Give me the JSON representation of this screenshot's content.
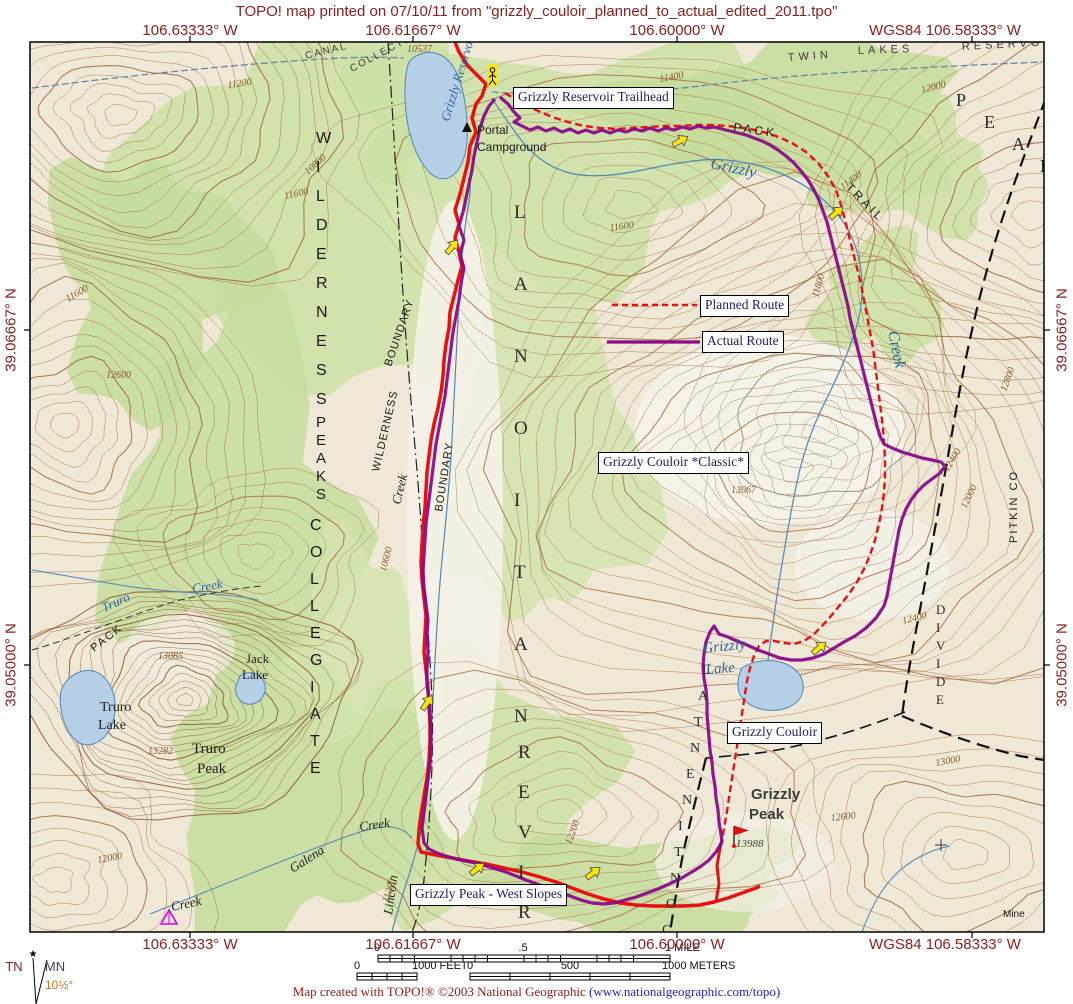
{
  "title": "TOPO! map printed on 07/10/11 from \"grizzly_couloir_planned_to_actual_edited_2011.tpo\"",
  "coords": {
    "top": [
      "106.63333° W",
      "106.61667° W",
      "106.60000° W",
      "WGS84 106.58333° W"
    ],
    "bottom": [
      "106.63333° W",
      "106.61667° W",
      "106.60000° W",
      "WGS84 106.58333° W"
    ],
    "left": [
      "39.06667° N",
      "39.05000° N"
    ],
    "right": [
      "39.06667° N",
      "39.05000° N"
    ]
  },
  "route_labels": {
    "trailhead": "Grizzly Reservoir Trailhead",
    "planned": "Planned Route",
    "actual": "Actual Route",
    "classic": "Grizzly Couloir *Classic*",
    "couloir": "Grizzly Couloir",
    "west_slopes": "Grizzly Peak - West Slopes"
  },
  "scale": {
    "mile": {
      "zero": "0",
      "half": ".5",
      "end": "1 MILE"
    },
    "feet": {
      "zero": "0",
      "end": "1000 FEET"
    },
    "meters": {
      "zero": "0",
      "mid": "500",
      "end": "1000 METERS"
    }
  },
  "compass": {
    "tn": "TN",
    "mn": "MN",
    "decl": "10½°"
  },
  "credit": {
    "text": "Map created with TOPO!® ©2003 National Geographic ",
    "link": "(www.nationalgeographic.com/topo)"
  },
  "colors": {
    "margin_text": "#8b2020",
    "planned_route": "#e81010",
    "actual_route": "#8b0a8b",
    "forest": "#cbe0a4",
    "contour": "#a5683c",
    "lake_fill": "#b5cfe6",
    "water_line": "#4f86b8",
    "waypoint_arrow": "#ffe800",
    "label_text": "#1e1e66"
  },
  "map": {
    "features": [
      {
        "text": "Grizzly Reservoir",
        "x": 449,
        "y": 122,
        "rot": -73,
        "cls": "water",
        "size": 13
      },
      {
        "text": "Portal",
        "x": 477,
        "y": 134,
        "cls": "admin",
        "size": 12
      },
      {
        "text": "Campground",
        "x": 477,
        "y": 151,
        "cls": "admin",
        "size": 12
      },
      {
        "text": "PACK",
        "x": 733,
        "y": 131,
        "rot": 8,
        "cls": "admin",
        "size": 12,
        "ls": 3
      },
      {
        "text": "TRAIL",
        "x": 845,
        "y": 188,
        "rot": 45,
        "cls": "admin",
        "size": 12,
        "ls": 3
      },
      {
        "text": "Grizzly",
        "x": 710,
        "y": 168,
        "rot": 12,
        "cls": "water",
        "size": 16
      },
      {
        "text": "Creek",
        "x": 888,
        "y": 332,
        "rot": 78,
        "cls": "water",
        "size": 16
      },
      {
        "text": "TWIN",
        "x": 788,
        "y": 61,
        "rot": -4,
        "cls": "admin2",
        "size": 11,
        "ls": 4
      },
      {
        "text": "LAKES",
        "x": 858,
        "y": 54,
        "rot": -2,
        "cls": "admin2",
        "size": 11,
        "ls": 4
      },
      {
        "text": "RESERVOIR",
        "x": 962,
        "y": 50,
        "rot": -3,
        "cls": "admin2",
        "size": 11,
        "ls": 4
      },
      {
        "text": "CANAL",
        "x": 306,
        "y": 59,
        "rot": -14,
        "cls": "admin2",
        "size": 10,
        "ls": 2
      },
      {
        "text": "COLLECTION",
        "x": 352,
        "y": 72,
        "rot": -28,
        "cls": "admin2",
        "size": 10,
        "ls": 2
      },
      {
        "text": "Grizzly",
        "x": 703,
        "y": 653,
        "rot": -6,
        "cls": "water",
        "size": 15
      },
      {
        "text": "Lake",
        "x": 706,
        "y": 674,
        "rot": -4,
        "cls": "water",
        "size": 15
      },
      {
        "text": "Truro",
        "x": 100,
        "y": 711,
        "cls": "dark",
        "size": 14
      },
      {
        "text": "Lake",
        "x": 98,
        "y": 729,
        "cls": "dark",
        "size": 14
      },
      {
        "text": "Jack",
        "x": 246,
        "y": 663,
        "cls": "dark",
        "size": 13
      },
      {
        "text": "Lake",
        "x": 242,
        "y": 679,
        "cls": "dark",
        "size": 13
      },
      {
        "text": "Truro",
        "x": 192,
        "y": 753,
        "cls": "dark",
        "size": 15
      },
      {
        "text": "Peak",
        "x": 197,
        "y": 773,
        "cls": "dark",
        "size": 15
      },
      {
        "text": "Truro",
        "x": 104,
        "y": 612,
        "rot": -24,
        "cls": "water",
        "size": 13
      },
      {
        "text": "Creek",
        "x": 193,
        "y": 593,
        "rot": -10,
        "cls": "water",
        "size": 13
      },
      {
        "text": "PACK",
        "x": 94,
        "y": 652,
        "rot": -38,
        "cls": "admin",
        "size": 11,
        "ls": 2
      },
      {
        "text": "Galena",
        "x": 293,
        "y": 873,
        "rot": -33,
        "cls": "darkit",
        "size": 13
      },
      {
        "text": "Creek",
        "x": 360,
        "y": 831,
        "rot": -8,
        "cls": "darkit",
        "size": 13
      },
      {
        "text": "Creek",
        "x": 172,
        "y": 911,
        "rot": -12,
        "cls": "darkit",
        "size": 13
      },
      {
        "text": "Lincoln",
        "x": 392,
        "y": 915,
        "rot": -82,
        "cls": "darkit",
        "size": 13
      },
      {
        "text": "Creek",
        "x": 400,
        "y": 505,
        "rot": -76,
        "cls": "darkit",
        "size": 13
      },
      {
        "text": "Grizzly",
        "x": 751,
        "y": 799,
        "cls": "peak",
        "size": 15
      },
      {
        "text": "Peak",
        "x": 749,
        "y": 819,
        "cls": "peak",
        "size": 15
      },
      {
        "text": "13988",
        "x": 736,
        "y": 847,
        "cls": "elevd",
        "size": 11
      },
      {
        "text": "Mine",
        "x": 1003,
        "y": 917,
        "cls": "admin",
        "size": 10
      },
      {
        "text": "BOUNDARY",
        "x": 391,
        "y": 367,
        "rot": -71,
        "cls": "admin",
        "size": 11,
        "ls": 1
      },
      {
        "text": "WILDERNESS",
        "x": 379,
        "y": 472,
        "rot": -77,
        "cls": "admin",
        "size": 11,
        "ls": 1
      },
      {
        "text": "BOUNDARY",
        "x": 442,
        "y": 512,
        "rot": -81,
        "cls": "admin",
        "size": 11,
        "ls": 1
      },
      {
        "text": "PITKIN CO",
        "x": 1017,
        "y": 543,
        "rot": -90,
        "cls": "admin",
        "size": 11,
        "ls": 2
      }
    ],
    "vertical_words": [
      {
        "text": "WILDERNESS",
        "x": 316,
        "y": 143,
        "dy": 29,
        "cls": "vword",
        "size": 16
      },
      {
        "text": "PEAKS",
        "x": 316,
        "y": 427,
        "dy": 18,
        "cls": "vword",
        "size": 15
      },
      {
        "text": "COLLEGIATE",
        "x": 310,
        "y": 530,
        "dy": 27,
        "cls": "vword",
        "size": 16
      },
      {
        "text": "NATIONAL",
        "x": 514,
        "y": 722,
        "dy": -72,
        "cls": "vbig",
        "size": 19
      },
      {
        "text": "RIVER",
        "x": 518,
        "y": 918,
        "dy": -40,
        "cls": "vbig",
        "size": 19
      },
      {
        "text": "PEAK",
        "x": 956,
        "y": 106,
        "dx": 28,
        "dy": 22,
        "cls": "vbig",
        "size": 18
      },
      {
        "text": "CONTINENTAL",
        "x": 662,
        "y": 934,
        "dx": 4,
        "dy": -26,
        "cls": "vmid",
        "size": 14
      },
      {
        "text": "DIVIDE",
        "x": 936,
        "y": 614,
        "dy": 18,
        "cls": "vmid",
        "size": 13
      }
    ],
    "elevations": [
      {
        "t": "10537",
        "x": 407,
        "y": 52,
        "r": 0
      },
      {
        "t": "11200",
        "x": 228,
        "y": 88,
        "r": -8
      },
      {
        "t": "11400",
        "x": 660,
        "y": 82,
        "r": -10
      },
      {
        "t": "12000",
        "x": 922,
        "y": 93,
        "r": -14
      },
      {
        "t": "11600",
        "x": 285,
        "y": 199,
        "r": -12
      },
      {
        "t": "10800",
        "x": 308,
        "y": 175,
        "r": -42
      },
      {
        "t": "11600",
        "x": 610,
        "y": 231,
        "r": -8
      },
      {
        "t": "11400",
        "x": 843,
        "y": 190,
        "r": -36
      },
      {
        "t": "11800",
        "x": 818,
        "y": 298,
        "r": -74
      },
      {
        "t": "12800",
        "x": 1006,
        "y": 392,
        "r": -70
      },
      {
        "t": "12400",
        "x": 948,
        "y": 472,
        "r": -58
      },
      {
        "t": "12000",
        "x": 966,
        "y": 509,
        "r": -64
      },
      {
        "t": "13067",
        "x": 731,
        "y": 493,
        "r": 0
      },
      {
        "t": "12400",
        "x": 903,
        "y": 624,
        "r": -14
      },
      {
        "t": "13000",
        "x": 936,
        "y": 766,
        "r": -10
      },
      {
        "t": "12800",
        "x": 798,
        "y": 733,
        "r": -8
      },
      {
        "t": "12600",
        "x": 831,
        "y": 821,
        "r": -6
      },
      {
        "t": "12200",
        "x": 571,
        "y": 845,
        "r": -70
      },
      {
        "t": "11200",
        "x": 388,
        "y": 903,
        "r": -72
      },
      {
        "t": "12000",
        "x": 98,
        "y": 863,
        "r": -10
      },
      {
        "t": "13085",
        "x": 158,
        "y": 659,
        "r": 0
      },
      {
        "t": "13282",
        "x": 148,
        "y": 754,
        "r": 0
      },
      {
        "t": "12600",
        "x": 106,
        "y": 378,
        "r": 0
      },
      {
        "t": "11600",
        "x": 68,
        "y": 302,
        "r": -30
      },
      {
        "t": "10600",
        "x": 386,
        "y": 572,
        "r": -76
      }
    ],
    "arrows": [
      {
        "x": 680,
        "y": 141,
        "r": -30
      },
      {
        "x": 836,
        "y": 213,
        "r": -42
      },
      {
        "x": 452,
        "y": 247,
        "r": -50
      },
      {
        "x": 427,
        "y": 703,
        "r": -55
      },
      {
        "x": 477,
        "y": 869,
        "r": -38
      },
      {
        "x": 593,
        "y": 873,
        "r": -38
      },
      {
        "x": 819,
        "y": 648,
        "r": -40
      }
    ]
  }
}
